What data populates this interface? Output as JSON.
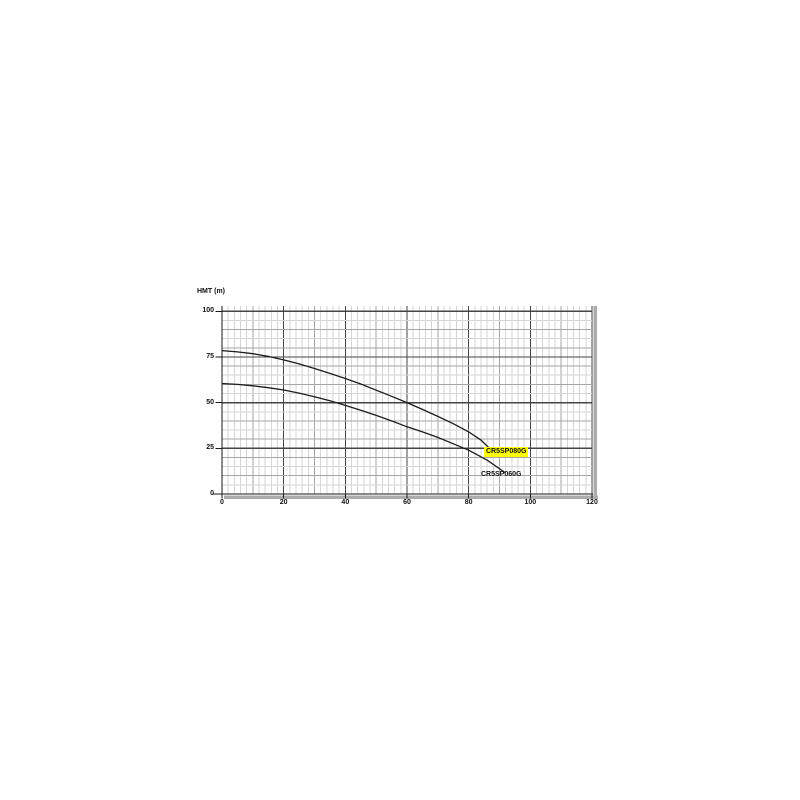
{
  "chart": {
    "y_axis_title": "HMT (m)"
  },
  "chart_data": {
    "type": "line",
    "title": "",
    "xlabel": "",
    "ylabel": "HMT (m)",
    "xlim": [
      0,
      120
    ],
    "ylim": [
      0,
      102.7
    ],
    "x_major_ticks": [
      0,
      20,
      40,
      60,
      80,
      100,
      120
    ],
    "y_major_ticks": [
      0,
      25,
      50,
      75,
      100
    ],
    "x_minor_step": 2,
    "x_medium_step": 10,
    "y_minor_step": 5,
    "y_medium_step": 10,
    "grid": "on",
    "legend_position": "inline-labels-at-curve-end",
    "colors": {
      "curve": "#1c1c1c",
      "grid_minor": "#d6d6d6",
      "grid_medium": "#a6a6a6",
      "grid_major": "#454545",
      "axis": "#1a1a1a",
      "shadow_band": "#ababab",
      "highlight": "#ffff00",
      "text": "#111111"
    },
    "series": [
      {
        "name": "CR5SP080G",
        "label_bg": "#ffff00",
        "points": [
          [
            0,
            78.5
          ],
          [
            5,
            77.8
          ],
          [
            10,
            76.8
          ],
          [
            15,
            75.3
          ],
          [
            20,
            73.4
          ],
          [
            25,
            71.2
          ],
          [
            30,
            68.7
          ],
          [
            35,
            66
          ],
          [
            40,
            63.2
          ],
          [
            45,
            60.2
          ],
          [
            50,
            56.8
          ],
          [
            55,
            53.5
          ],
          [
            60,
            50
          ],
          [
            65,
            46.3
          ],
          [
            70,
            42.5
          ],
          [
            75,
            38.5
          ],
          [
            80,
            34
          ],
          [
            84,
            29.5
          ],
          [
            88,
            23
          ]
        ]
      },
      {
        "name": "CR5SP060G",
        "label_bg": "",
        "points": [
          [
            0,
            60.5
          ],
          [
            5,
            60
          ],
          [
            10,
            59.2
          ],
          [
            15,
            58.2
          ],
          [
            20,
            56.9
          ],
          [
            25,
            55.2
          ],
          [
            30,
            53.2
          ],
          [
            35,
            51
          ],
          [
            40,
            48.5
          ],
          [
            45,
            45.8
          ],
          [
            50,
            43
          ],
          [
            55,
            40
          ],
          [
            60,
            36.8
          ],
          [
            65,
            34
          ],
          [
            70,
            31
          ],
          [
            75,
            27.5
          ],
          [
            80,
            24
          ],
          [
            86,
            18.5
          ],
          [
            92,
            11.5
          ]
        ]
      }
    ]
  }
}
